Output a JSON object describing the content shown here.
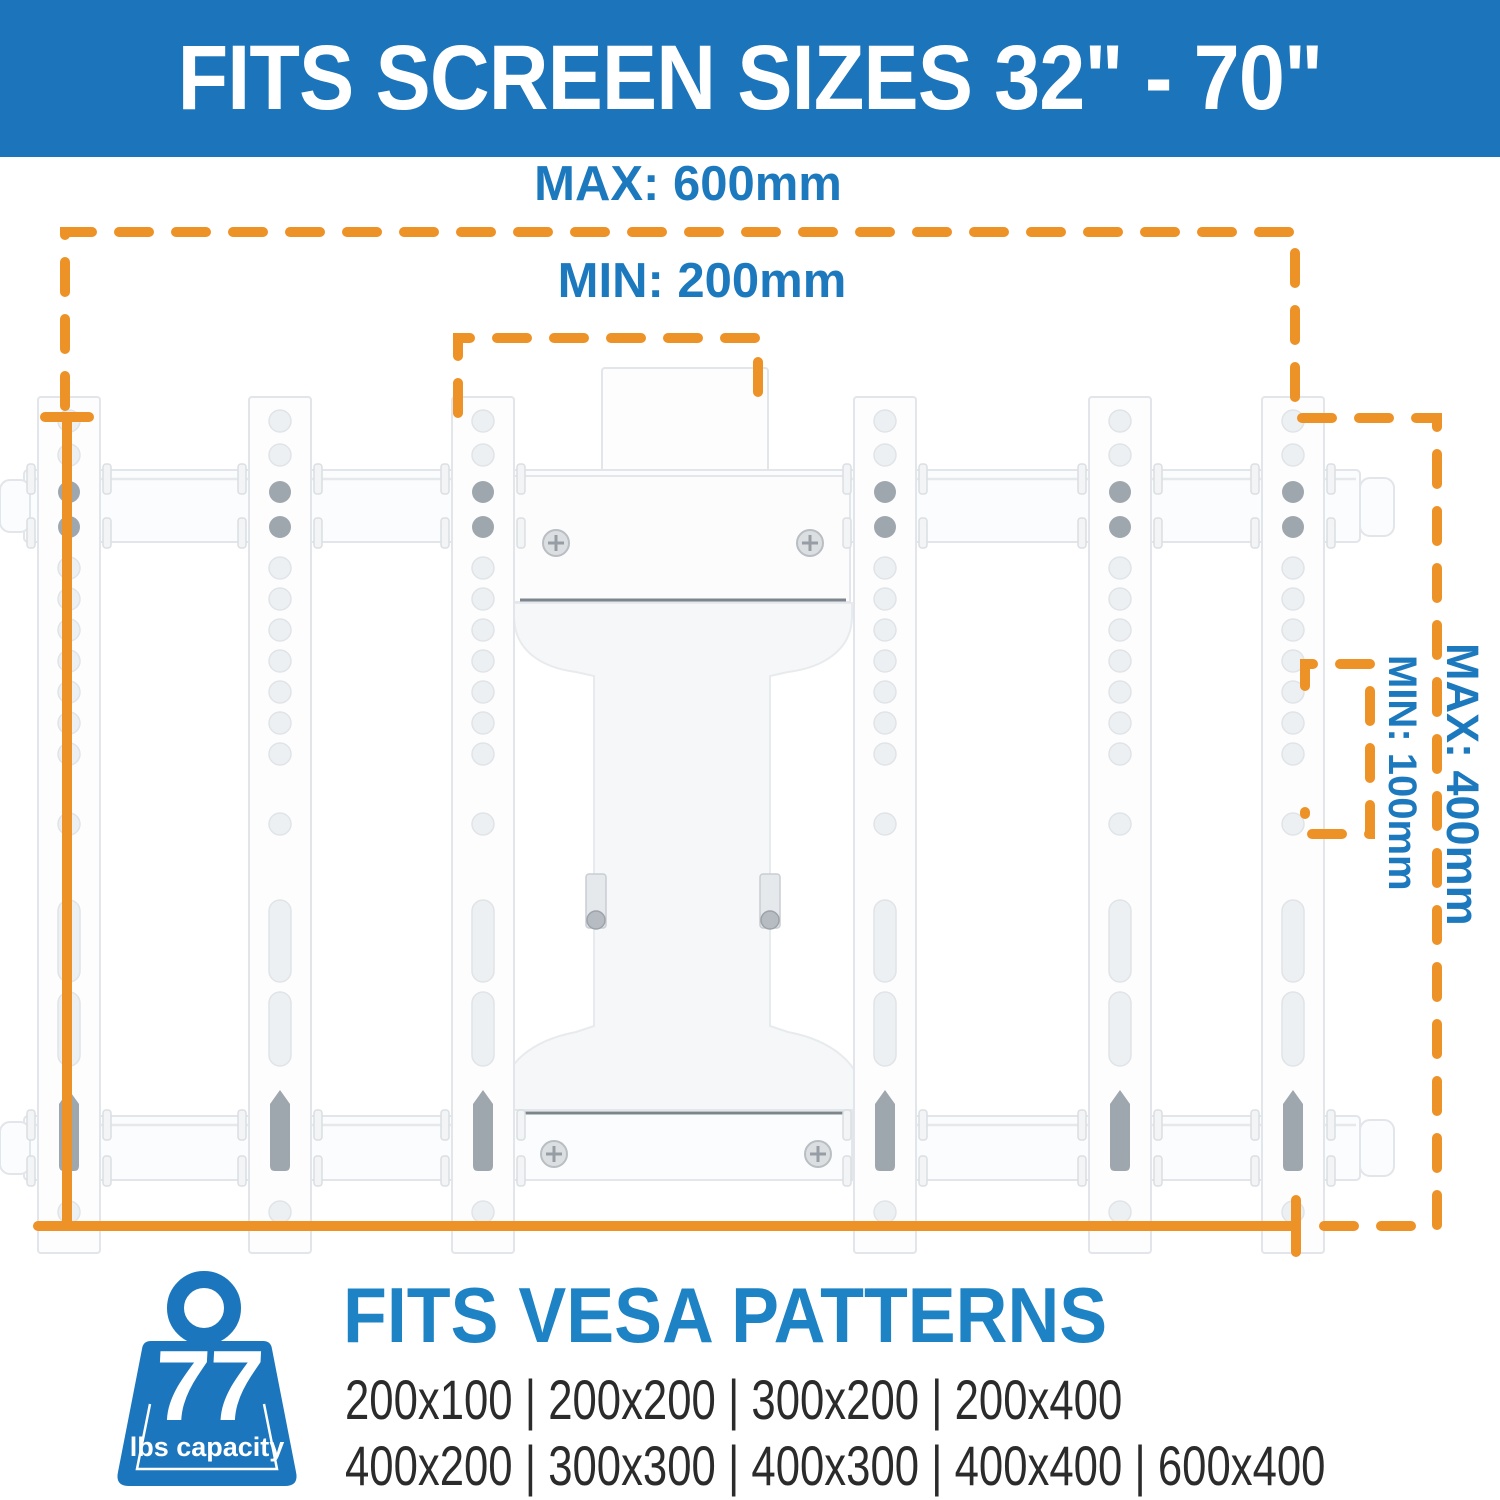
{
  "header": {
    "title": "FITS SCREEN SIZES 32\" - 70\""
  },
  "diagram": {
    "labels": {
      "max_width": "MAX: 600mm",
      "min_width": "MIN: 200mm",
      "max_height": "MAX: 400mm",
      "min_height": "MIN: 100mm"
    }
  },
  "capacity": {
    "value": "77",
    "unit": "lbs capacity"
  },
  "vesa": {
    "heading": "FITS VESA PATTERNS",
    "rows": [
      "200x100 | 200x200 | 300x200 | 200x400",
      "400x200 | 300x300 | 400x300 | 400x400 | 600x400"
    ]
  },
  "colors": {
    "header_bg": "#1C74BA",
    "label_blue": "#1D79BE",
    "heading_blue": "#1E83C5",
    "orange": "#ED9227",
    "badge_blue": "#1B76BD",
    "ink": "#2B2B2B"
  }
}
